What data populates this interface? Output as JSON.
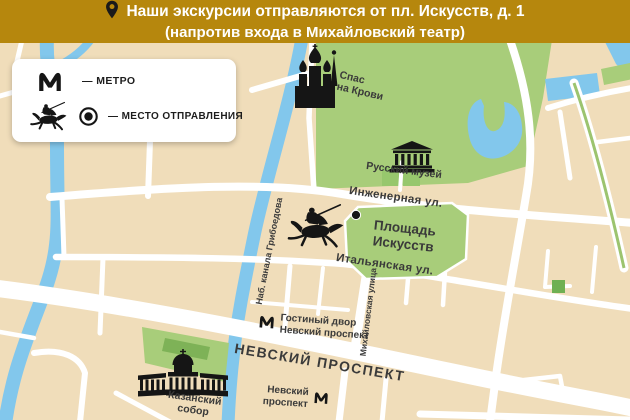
{
  "banner": {
    "bg_color": "#B6870D",
    "line1": "Наши экскурсии отправляются от пл. Искусств, д. 1",
    "line2": "(напротив входа в Михайловский театр)"
  },
  "legend": {
    "metro_label": "— МЕТРО",
    "departure_label": "— МЕСТО ОТПРАВЛЕНИЯ"
  },
  "map": {
    "colors": {
      "land": "#F0DDBA",
      "water": "#82C7EC",
      "park": "#A8CD7A",
      "street": "#FFFFFF",
      "label_text": "#3A3A3A"
    },
    "landmarks": {
      "spas_line1": "Спас",
      "spas_line2": "на Крови",
      "russian_museum": "Русский музей",
      "ploshchad_line1": "Площадь",
      "ploshchad_line2": "Искусств",
      "kazansky_line1": "Казанский",
      "kazansky_line2": "собор"
    },
    "streets": {
      "inzhenernaya": "Инженерная ул.",
      "italyanskaya": "Итальянская ул.",
      "griboedova": "Наб. канала Грибоедова",
      "mikhailovskaya": "Михайловская улица",
      "nevsky": "НЕВСКИЙ ПРОСПЕКТ"
    },
    "metro_stations": {
      "gostiny_line1": "Гостиный двор",
      "gostiny_line2": "Невский проспект",
      "nevsky_line1": "Невский",
      "nevsky_line2": "проспект"
    }
  }
}
